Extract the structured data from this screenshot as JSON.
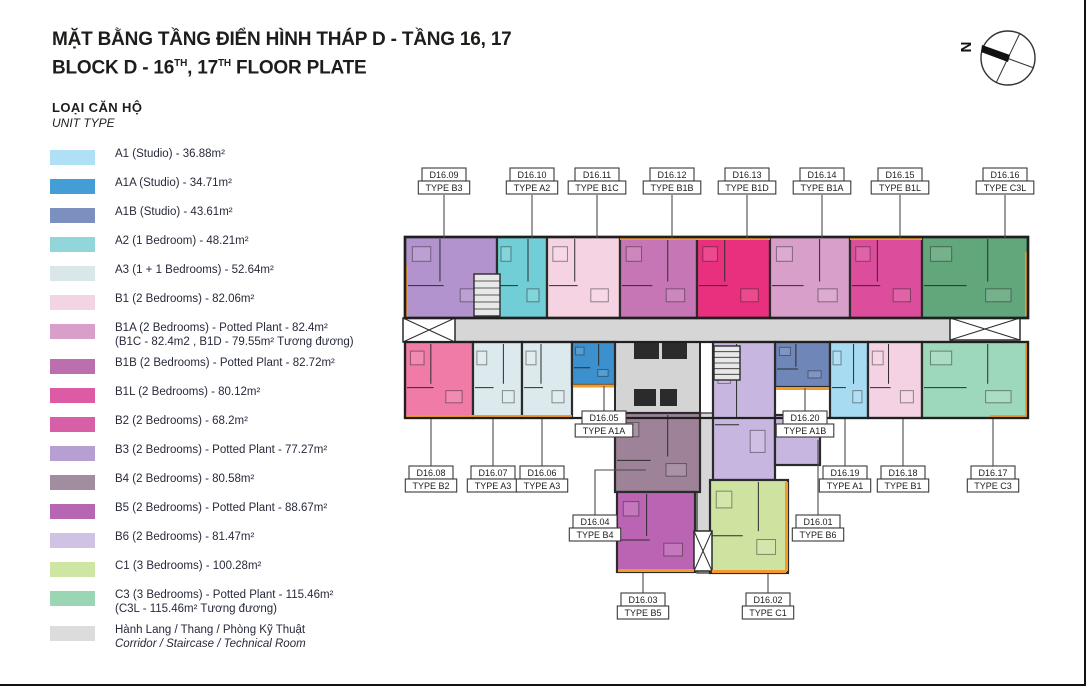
{
  "title": {
    "line1": "MẶT BẰNG TẦNG ĐIỂN HÌNH THÁP D - TẦNG 16, 17",
    "line2_parts": [
      "BLOCK D - 16",
      "TH",
      ", 17",
      "TH",
      "  FLOOR PLATE"
    ]
  },
  "compass": {
    "label": "N"
  },
  "legend": {
    "heading_vi": "LOẠI CĂN HỘ",
    "heading_en": "UNIT TYPE",
    "items": [
      {
        "color": "#AFE0F5",
        "line1": "A1 (Studio) - 36.88m²"
      },
      {
        "color": "#459DD6",
        "line1": "A1A (Studio) - 34.71m²"
      },
      {
        "color": "#7B90BE",
        "line1": "A1B (Studio) - 43.61m²"
      },
      {
        "color": "#93D6DA",
        "line1": "A2 (1 Bedroom) - 48.21m²"
      },
      {
        "color": "#D9E7EB",
        "line1": "A3 (1 + 1 Bedrooms) - 52.64m²"
      },
      {
        "color": "#F2D4E5",
        "line1": "B1 (2 Bedrooms) - 82.06m²"
      },
      {
        "color": "#D79FC9",
        "line1": "B1A (2 Bedrooms) - Potted Plant - 82.4m²",
        "line2": "(B1C - 82.4m2 , B1D - 79.55m² Tương đương)"
      },
      {
        "color": "#BC6FAE",
        "line1": "B1B (2 Bedrooms) - Potted Plant - 82.72m²"
      },
      {
        "color": "#DD5BA4",
        "line1": "B1L (2 Bedrooms) - 80.12m²"
      },
      {
        "color": "#D75FA8",
        "line1": "B2 (2 Bedrooms) - 68.2m²"
      },
      {
        "color": "#B79FD4",
        "line1": "B3 (2 Bedrooms) - Potted Plant - 77.27m²"
      },
      {
        "color": "#A18CA0",
        "line1": "B4 (2 Bedrooms) - 80.58m²"
      },
      {
        "color": "#B666B2",
        "line1": "B5 (2 Bedrooms) - Potted Plant - 88.67m²"
      },
      {
        "color": "#CFC2E5",
        "line1": "B6 (2 Bedrooms) - 81.47m²"
      },
      {
        "color": "#CFE5A4",
        "line1": "C1 (3 Bedrooms) - 100.28m²"
      },
      {
        "color": "#9AD6B4",
        "line1": "C3 (3 Bedrooms) - Potted Plant - 115.46m²",
        "line2": "(C3L - 115.46m² Tương đương)"
      },
      {
        "color": "#DCDCDC",
        "line1": "Hành Lang / Thang / Phòng Kỹ Thuật",
        "line2_italic": "Corridor / Staircase / Technical Room"
      }
    ]
  },
  "plan": {
    "colors": {
      "corridor": "#D6D6D6",
      "core": "#D4D4D4",
      "accent": "#F49A2B",
      "wall": "#2b2b2b"
    },
    "units": [
      {
        "code": "D16.09",
        "type": "TYPE B3",
        "color": "#B393CE",
        "rect": [
          405,
          237,
          92,
          81
        ],
        "label": {
          "cx": 444,
          "y": 168
        },
        "leader": [
          [
            444,
            195
          ],
          [
            444,
            238
          ]
        ]
      },
      {
        "code": "D16.10",
        "type": "TYPE A2",
        "color": "#72CED6",
        "rect": [
          497,
          237,
          50,
          81
        ],
        "label": {
          "cx": 532,
          "y": 168
        },
        "leader": [
          [
            532,
            195
          ],
          [
            532,
            238
          ]
        ]
      },
      {
        "code": "D16.11",
        "type": "TYPE B1C",
        "color": "#F5D3E2",
        "rect": [
          547,
          237,
          73,
          81
        ],
        "label": {
          "cx": 597,
          "y": 168
        },
        "leader": [
          [
            597,
            195
          ],
          [
            597,
            238
          ]
        ]
      },
      {
        "code": "D16.12",
        "type": "TYPE B1B",
        "color": "#C776B5",
        "rect": [
          620,
          237,
          77,
          81
        ],
        "label": {
          "cx": 672,
          "y": 168
        },
        "leader": [
          [
            672,
            195
          ],
          [
            672,
            238
          ]
        ]
      },
      {
        "code": "D16.13",
        "type": "TYPE B1D",
        "color": "#E9307F",
        "rect": [
          697,
          237,
          73,
          81
        ],
        "label": {
          "cx": 747,
          "y": 168
        },
        "leader": [
          [
            747,
            195
          ],
          [
            747,
            238
          ]
        ]
      },
      {
        "code": "D16.14",
        "type": "TYPE B1A",
        "color": "#D89FCB",
        "rect": [
          770,
          237,
          80,
          81
        ],
        "label": {
          "cx": 822,
          "y": 168
        },
        "leader": [
          [
            822,
            195
          ],
          [
            822,
            238
          ]
        ]
      },
      {
        "code": "D16.15",
        "type": "TYPE B1L",
        "color": "#DC4D9B",
        "rect": [
          850,
          237,
          72,
          81
        ],
        "label": {
          "cx": 900,
          "y": 168
        },
        "leader": [
          [
            900,
            195
          ],
          [
            900,
            238
          ]
        ]
      },
      {
        "code": "D16.16",
        "type": "TYPE C3L",
        "color": "#61A77B",
        "rect": [
          922,
          237,
          106,
          81
        ],
        "label": {
          "cx": 1005,
          "y": 168
        },
        "leader": [
          [
            1005,
            195
          ],
          [
            1005,
            238
          ]
        ]
      },
      {
        "code": "D16.08",
        "type": "TYPE B2",
        "color": "#F07BA6",
        "rect": [
          405,
          342,
          68,
          76
        ],
        "label": {
          "cx": 431,
          "y": 466
        },
        "leader": [
          [
            431,
            466
          ],
          [
            431,
            419
          ]
        ]
      },
      {
        "code": "D16.07",
        "type": "TYPE A3",
        "color": "#DCE9ED",
        "rect": [
          473,
          342,
          49,
          76
        ],
        "label": {
          "cx": 493,
          "y": 466
        },
        "leader": [
          [
            493,
            466
          ],
          [
            493,
            419
          ]
        ]
      },
      {
        "code": "D16.06",
        "type": "TYPE A3",
        "color": "#DCE9ED",
        "rect": [
          522,
          342,
          50,
          76
        ],
        "label": {
          "cx": 542,
          "y": 466
        },
        "leader": [
          [
            542,
            466
          ],
          [
            542,
            419
          ]
        ]
      },
      {
        "code": "D16.05",
        "type": "TYPE A1A",
        "color": "#3C90CE",
        "rect": [
          572,
          342,
          43,
          43
        ],
        "label": {
          "cx": 604,
          "y": 411
        },
        "leader": [
          [
            604,
            411
          ],
          [
            604,
            386
          ]
        ]
      },
      {
        "code": "D16.20",
        "type": "TYPE A1B",
        "color": "#6E86B8",
        "rect": [
          775,
          342,
          55,
          45
        ],
        "label": {
          "cx": 805,
          "y": 411
        },
        "leader": [
          [
            805,
            411
          ],
          [
            805,
            388
          ]
        ]
      },
      {
        "code": "D16.19",
        "type": "TYPE A1",
        "color": "#A7DBF2",
        "rect": [
          830,
          342,
          38,
          76
        ],
        "label": {
          "cx": 845,
          "y": 466
        },
        "leader": [
          [
            845,
            466
          ],
          [
            845,
            419
          ]
        ]
      },
      {
        "code": "D16.18",
        "type": "TYPE B1",
        "color": "#F4D2E3",
        "rect": [
          868,
          342,
          54,
          76
        ],
        "label": {
          "cx": 903,
          "y": 466
        },
        "leader": [
          [
            903,
            466
          ],
          [
            903,
            419
          ]
        ]
      },
      {
        "code": "D16.17",
        "type": "TYPE C3",
        "color": "#9ED8BA",
        "rect": [
          922,
          342,
          106,
          76
        ],
        "label": {
          "cx": 993,
          "y": 466
        },
        "leader": [
          [
            993,
            466
          ],
          [
            993,
            419
          ]
        ]
      },
      {
        "code": "D16.01",
        "type": "TYPE B6",
        "color": "#C7B6DF",
        "rect": [
          713,
          342,
          62,
          138
        ],
        "rect2": [
          775,
          415,
          45,
          50
        ],
        "label": {
          "cx": 818,
          "y": 515
        },
        "leader": [
          [
            818,
            515
          ],
          [
            818,
            440
          ]
        ]
      },
      {
        "code": "D16.04",
        "type": "TYPE B4",
        "color": "#9D8298",
        "rect": [
          615,
          413,
          85,
          79
        ],
        "label": {
          "cx": 595,
          "y": 515
        },
        "leader": [
          [
            595,
            515
          ],
          [
            595,
            470
          ],
          [
            646,
            470
          ]
        ]
      },
      {
        "code": "D16.03",
        "type": "TYPE B5",
        "color": "#BC64B4",
        "rect": [
          617,
          492,
          78,
          80
        ],
        "label": {
          "cx": 643,
          "y": 593
        },
        "leader": [
          [
            643,
            593
          ],
          [
            643,
            573
          ]
        ]
      },
      {
        "code": "D16.02",
        "type": "TYPE C1",
        "color": "#CDE39F",
        "rect": [
          710,
          480,
          78,
          93
        ],
        "label": {
          "cx": 768,
          "y": 593
        },
        "leader": [
          [
            768,
            593
          ],
          [
            768,
            574
          ]
        ]
      }
    ]
  }
}
